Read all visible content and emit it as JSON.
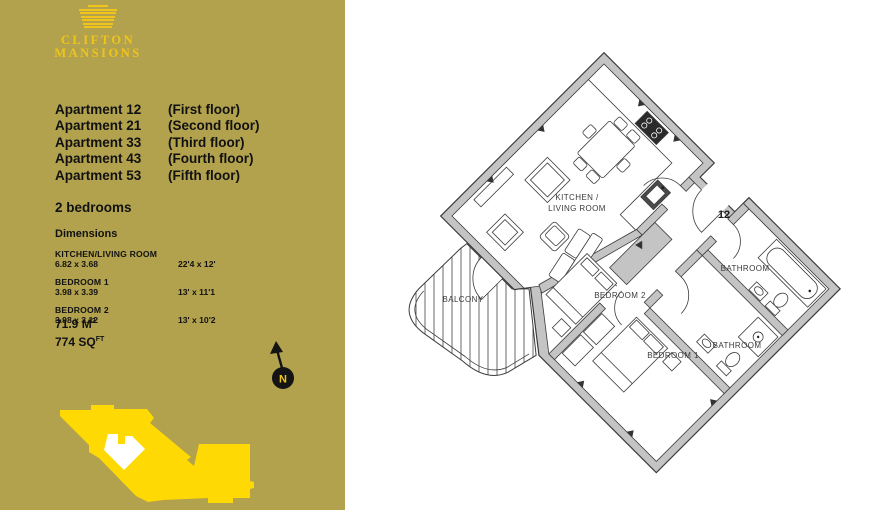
{
  "brand": {
    "line1": "CLIFTON",
    "line2": "MANSIONS"
  },
  "apartments": [
    {
      "name": "Apartment 12",
      "floor": "(First floor)"
    },
    {
      "name": "Apartment 21",
      "floor": "(Second floor)"
    },
    {
      "name": "Apartment 33",
      "floor": "(Third floor)"
    },
    {
      "name": "Apartment 43",
      "floor": "(Fourth floor)"
    },
    {
      "name": "Apartment 53",
      "floor": "(Fifth floor)"
    }
  ],
  "bedrooms_line": "2 bedrooms",
  "dimensions": {
    "heading": "Dimensions",
    "rooms": [
      {
        "name": "KITCHEN/LIVING ROOM",
        "metric": "6.82 x 3.68",
        "imperial": "22'4 x 12'"
      },
      {
        "name": "BEDROOM 1",
        "metric": "3.98 x 3.39",
        "imperial": "13' x 11'1"
      },
      {
        "name": "BEDROOM 2",
        "metric": "3.98 x 3.12",
        "imperial": "13' x 10'2"
      }
    ],
    "area_m2": "71.9 M",
    "area_m2_sup": "2",
    "area_sqft": "774 SQ",
    "area_sqft_sup": "FT"
  },
  "compass": {
    "label": "N"
  },
  "plan": {
    "labels": {
      "kitchen_line1": "KITCHEN /",
      "kitchen_line2": "LIVING ROOM",
      "bedroom2": "BEDROOM 2",
      "bedroom1": "BEDROOM 1",
      "bathroom1": "BATHROOM",
      "bathroom2": "BATHROOM",
      "balcony": "BALCONY",
      "unit_number": "12"
    }
  },
  "icons": {
    "logo": "striped-building-logo",
    "compass": "north-arrow-compass",
    "footprint": "building-footprint-keyplan"
  },
  "colors": {
    "panel_bg": "#b2a24e",
    "accent_yellow": "#f0c41a",
    "footprint_yellow": "#ffd903",
    "wall_gray": "#c4c4c4",
    "line_dark": "#3c3c3c"
  }
}
